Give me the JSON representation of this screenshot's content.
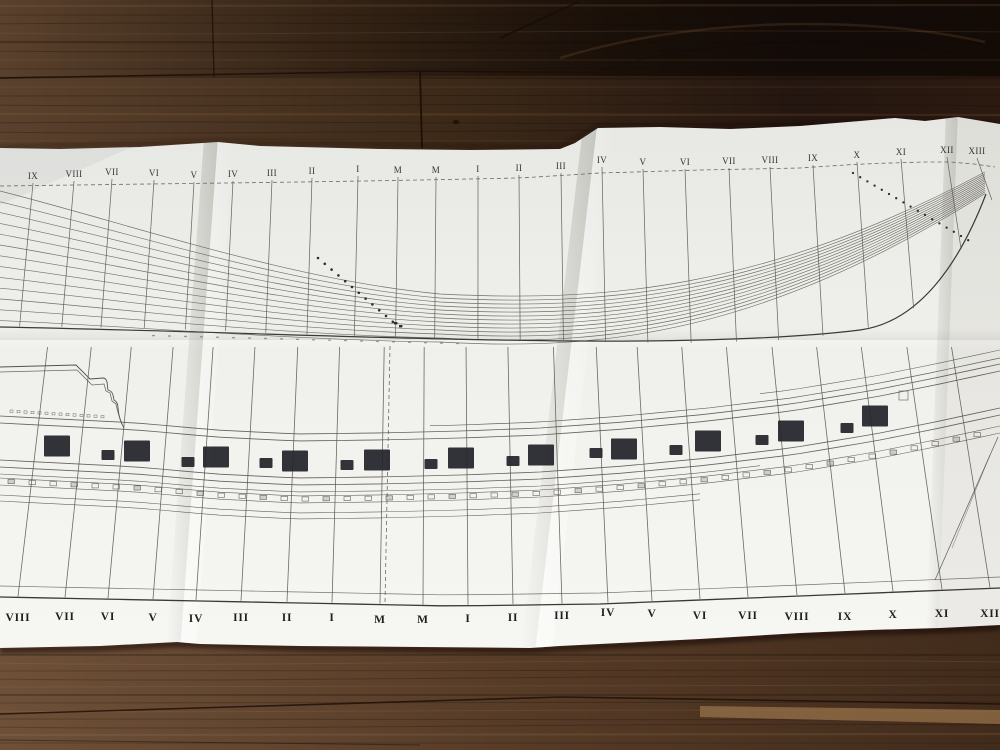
{
  "scene": {
    "description": "Photograph of a folded ship plan (waterline lines-plan above, sheer profile with gun ports below) lying on a dark wooden table",
    "surface": "wood-table",
    "sheet": "folded-plan-sheet"
  },
  "colors": {
    "paper_top": "#e7e8e4",
    "paper_mid": "#f1f1ed",
    "paper_bottom": "#f6f6f2",
    "ink": "#55534d",
    "ink_heavy": "#3b3934",
    "port_fill": "#24252a",
    "wood_top_light": "#5a412d",
    "wood_top_dark": "#241610",
    "wood_bottom_light": "#6e5038",
    "wood_bottom_dark": "#412b1b",
    "wood_seam": "#1b0e06",
    "wood_tan_strip": "#957149"
  },
  "upper_plan": {
    "name": "half-breadth waterlines plan",
    "station_labels": [
      "IX",
      "VIII",
      "VII",
      "VI",
      "V",
      "IV",
      "III",
      "II",
      "I",
      "M",
      "M",
      "I",
      "II",
      "III",
      "IV",
      "V",
      "VI",
      "VII",
      "VIII",
      "IX",
      "X",
      "XI",
      "XII",
      "XIII"
    ],
    "waterline_count": 13,
    "diagonal_dot_runs": 2
  },
  "lower_plan": {
    "name": "sheer profile with gun ports",
    "station_labels": [
      "VIII",
      "VII",
      "VI",
      "V",
      "IV",
      "III",
      "II",
      "I",
      "M",
      "M",
      "I",
      "II",
      "III",
      "IV",
      "V",
      "VI",
      "VII",
      "VIII",
      "IX",
      "X",
      "XI",
      "XII"
    ],
    "large_ports": [
      {
        "cx": 57,
        "cy": 446
      },
      {
        "cx": 137,
        "cy": 451
      },
      {
        "cx": 216,
        "cy": 457
      },
      {
        "cx": 295,
        "cy": 461
      },
      {
        "cx": 377,
        "cy": 460
      },
      {
        "cx": 461,
        "cy": 458
      },
      {
        "cx": 541,
        "cy": 455
      },
      {
        "cx": 624,
        "cy": 449
      },
      {
        "cx": 708,
        "cy": 441
      },
      {
        "cx": 791,
        "cy": 431
      },
      {
        "cx": 875,
        "cy": 416
      }
    ],
    "small_ports": [
      {
        "cx": 108,
        "cy": 455
      },
      {
        "cx": 188,
        "cy": 462
      },
      {
        "cx": 266,
        "cy": 463
      },
      {
        "cx": 347,
        "cy": 465
      },
      {
        "cx": 431,
        "cy": 464
      },
      {
        "cx": 513,
        "cy": 461
      },
      {
        "cx": 596,
        "cy": 453
      },
      {
        "cx": 676,
        "cy": 450
      },
      {
        "cx": 762,
        "cy": 440
      },
      {
        "cx": 847,
        "cy": 428
      }
    ]
  }
}
